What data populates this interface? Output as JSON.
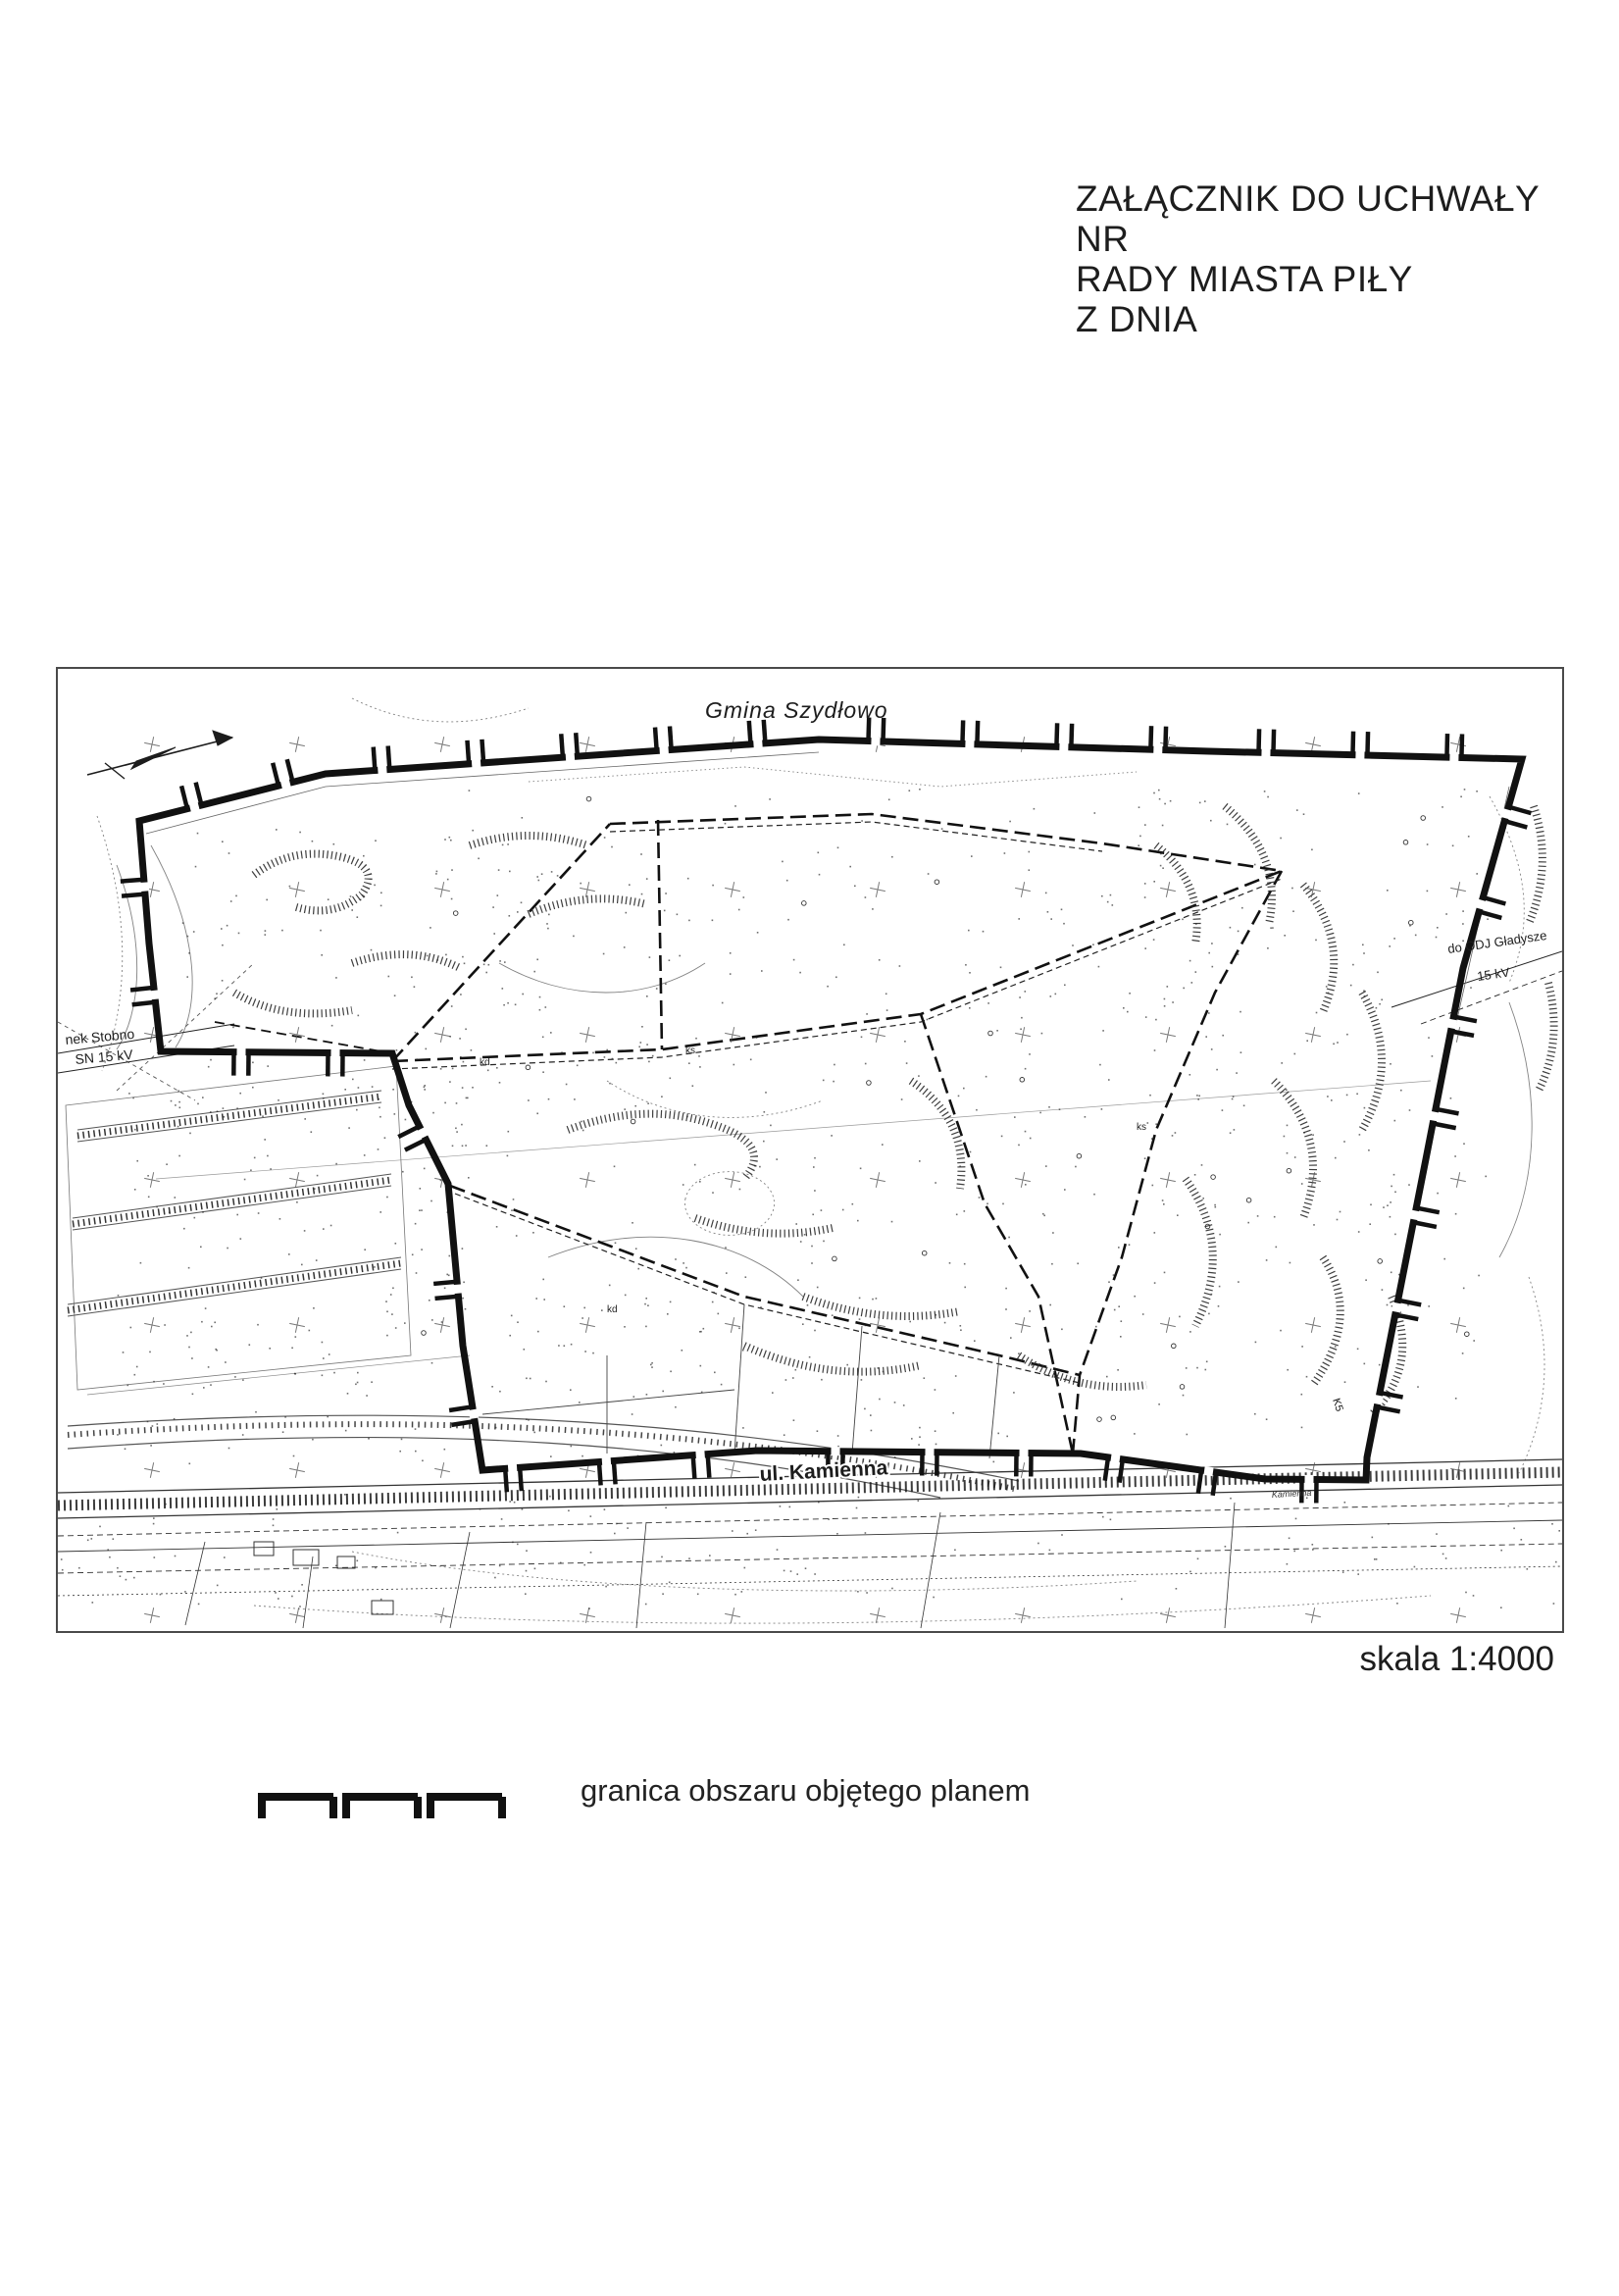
{
  "header": {
    "lines": [
      "ZAŁĄCZNIK DO UCHWAŁY",
      "NR",
      "RADY MIASTA PIŁY",
      "Z DNIA"
    ]
  },
  "map": {
    "region_label_top": "Gmina Szydłowo",
    "street_label": "ul. Kamienna",
    "street_label_small": "Kamienna",
    "left_power_label": {
      "line1": "nek Stobno",
      "line2": "SN 15 kV"
    },
    "right_power_label": {
      "line1": "do ODJ Gładysze",
      "line2": "15 kV"
    },
    "utility_labels": {
      "kd": "kd",
      "ks": "ks",
      "k5": "K5"
    }
  },
  "scale_label": "skala 1:4000",
  "legend": {
    "boundary": "granica obszaru objętego planem"
  },
  "colors": {
    "ink": "#1c1c1c",
    "boundary": "#111111",
    "light_line": "#777777"
  }
}
